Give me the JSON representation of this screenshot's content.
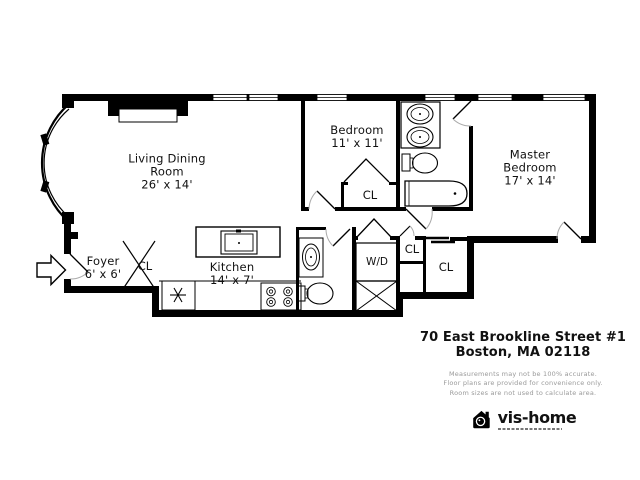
{
  "colors": {
    "wall": "#000000",
    "label_text": "#111111",
    "disclaimer_text": "#9a9a9a",
    "background": "#ffffff"
  },
  "floor_plan": {
    "rooms": {
      "living_dining": {
        "line1": "Living Dining",
        "line2": "Room",
        "dims": "26' x 14'"
      },
      "bedroom": {
        "line1": "Bedroom",
        "dims": "11' x 11'"
      },
      "master_bedroom": {
        "line1": "Master",
        "line2": "Bedroom",
        "dims": "17' x 14'"
      },
      "kitchen": {
        "line1": "Kitchen",
        "dims": "14' x 7'"
      },
      "foyer": {
        "line1": "Foyer",
        "dims": "6' x 6'"
      }
    },
    "closets": {
      "bedroom_closet": "CL",
      "foyer_closet": "CL",
      "hall_closet_small": "CL",
      "hall_closet_large": "CL"
    },
    "laundry": {
      "label": "W/D"
    },
    "icons": {
      "entry": "entry-arrow-icon",
      "refrigerator": "snowflake-icon",
      "stove": "four-burner-stove-icon",
      "shaft": "x-crossed-box-icon",
      "logo": "vis-home-house-camera-icon"
    }
  },
  "annotation": {
    "address_line1": "70 East Brookline Street #1",
    "address_line2": "Boston, MA 02118",
    "disclaimer_line1": "Measurements may not be 100% accurate.",
    "disclaimer_line2": "Floor plans are provided for convenience only.",
    "disclaimer_line3": "Room sizes are not used to calculate area.",
    "logo_text": "vis-home"
  }
}
